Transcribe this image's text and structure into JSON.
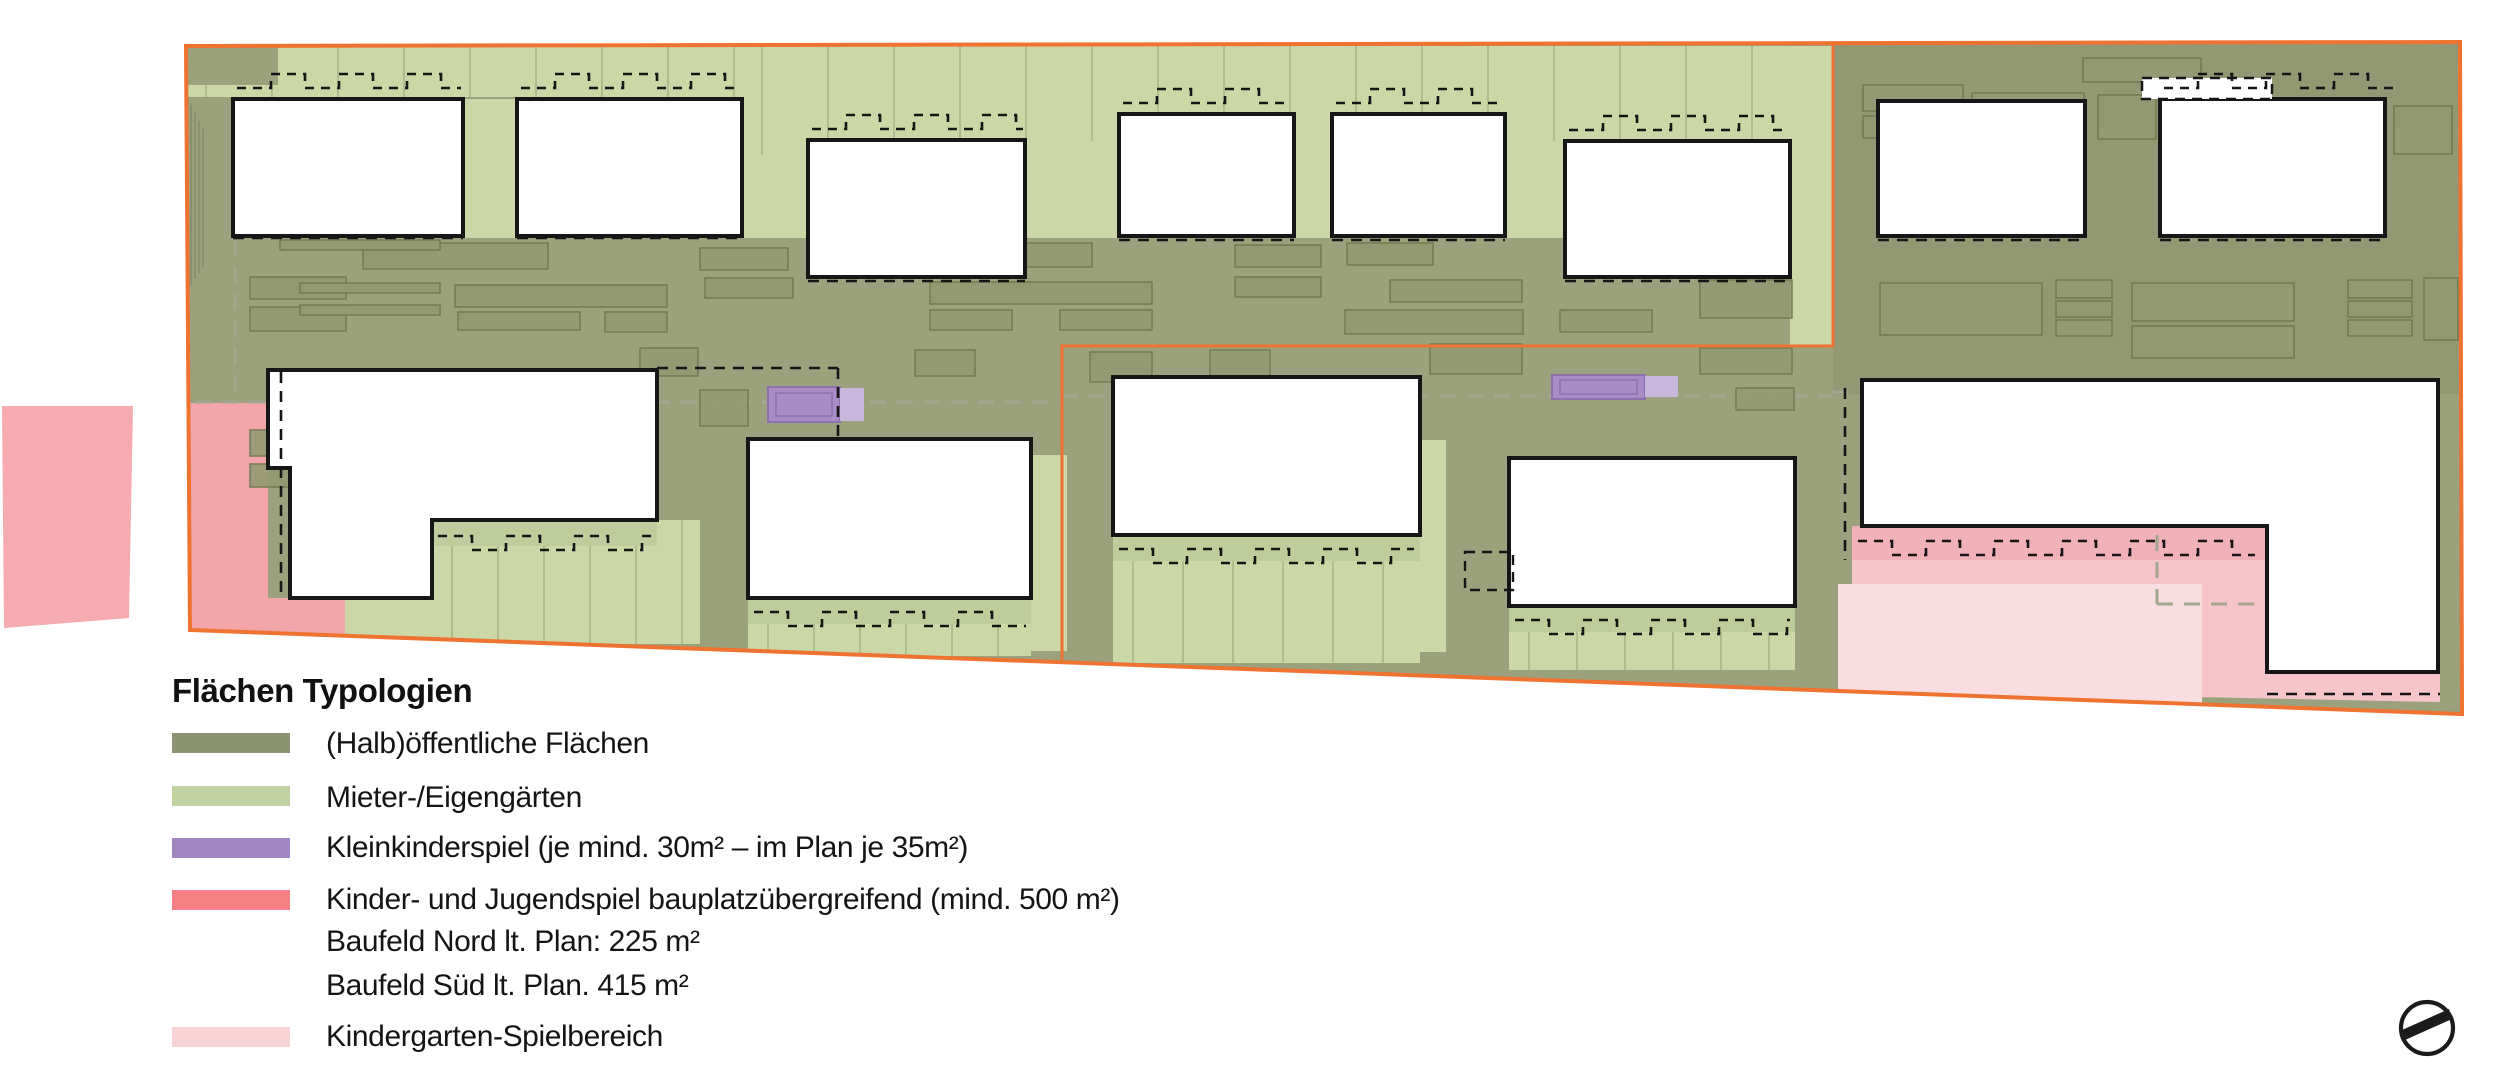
{
  "legend": {
    "title": "Flächen Typologien",
    "items": [
      {
        "id": "halboeffentliche",
        "label": "(Halb)öffentliche Flächen",
        "color": "#8c9472"
      },
      {
        "id": "mieter-eigengaerten",
        "label": "Mieter-/Eigengärten",
        "color": "#c2d2a0"
      },
      {
        "id": "kleinkinderspiel",
        "label": "Kleinkinderspiel (je mind. 30m² – im Plan je 35m²)",
        "color": "#a186c2"
      },
      {
        "id": "kinder-jugendspiel",
        "label": "Kinder- und Jugendspiel bauplatzübergreifend (mind. 500 m²)",
        "color": "#f47f85",
        "sublines": [
          "Baufeld Nord lt. Plan: 225 m²",
          "Baufeld Süd lt. Plan.   415 m²"
        ]
      },
      {
        "id": "kindergarten-spielbereich",
        "label": "Kindergarten-Spielbereich",
        "color": "#f8d3d6"
      }
    ]
  },
  "plan": {
    "colors": {
      "olive": "#9ba17c",
      "shade": "rgba(70,76,52,0.10)",
      "light": "#cbd7a7",
      "hatch": "#bfcc9c",
      "pink": "#f2a6aa",
      "pinkDetached": "#f5abaf",
      "pinkLight": "#f5c5ca",
      "pinkStrip": "#f0b1b8",
      "pinkLighter": "#fadde0",
      "purple": "#a98bc6",
      "purpleLight": "#c9b6dc",
      "purpleStroke": "#8d6fae",
      "smallFill": "#939a73",
      "smallStroke": "#71784f",
      "white": "#ffffff",
      "black": "#161616",
      "orange": "#ee7330",
      "gray": "#a2a78e",
      "tex": "rgba(110,122,80,0.40)"
    },
    "boundary": [
      [
        186,
        46
      ],
      [
        2460,
        42
      ],
      [
        2462,
        714
      ],
      [
        190,
        630
      ]
    ],
    "divider": [
      [
        1833,
        42
      ],
      [
        1833,
        346
      ],
      [
        1062,
        346
      ],
      [
        1062,
        660
      ]
    ],
    "zones": [
      {
        "t": "poly",
        "f": "olive",
        "pts": [
          [
            186,
            46
          ],
          [
            2460,
            42
          ],
          [
            2462,
            714
          ],
          [
            190,
            630
          ]
        ]
      },
      {
        "t": "rect",
        "f": "shade",
        "x": 1833,
        "y": 42,
        "w": 627,
        "h": 352
      },
      {
        "t": "rect",
        "f": "light",
        "x": 186,
        "y": 46,
        "w": 1647,
        "h": 51,
        "ln": 66
      },
      {
        "t": "rect",
        "f": "light",
        "x": 742,
        "y": 46,
        "w": 1091,
        "h": 109,
        "ln": 66
      },
      {
        "t": "rect",
        "f": "olive",
        "x": 186,
        "y": 46,
        "w": 92,
        "h": 39
      },
      {
        "t": "rect",
        "f": "light",
        "x": 463,
        "y": 99,
        "w": 54,
        "h": 139
      },
      {
        "t": "rect",
        "f": "light",
        "x": 742,
        "y": 155,
        "w": 66,
        "h": 83
      },
      {
        "t": "rect",
        "f": "light",
        "x": 1025,
        "y": 141,
        "w": 94,
        "h": 97
      },
      {
        "t": "rect",
        "f": "light",
        "x": 1294,
        "y": 114,
        "w": 38,
        "h": 124
      },
      {
        "t": "rect",
        "f": "light",
        "x": 1505,
        "y": 141,
        "w": 60,
        "h": 97
      },
      {
        "t": "rect",
        "f": "light",
        "x": 1790,
        "y": 46,
        "w": 43,
        "h": 300
      },
      {
        "t": "rect",
        "f": "light",
        "x": 432,
        "y": 520,
        "w": 268,
        "h": 124,
        "ln": 46
      },
      {
        "t": "rect",
        "f": "hatch",
        "x": 432,
        "y": 520,
        "w": 225,
        "h": 26
      },
      {
        "t": "rect",
        "f": "light",
        "x": 345,
        "y": 598,
        "w": 87,
        "h": 46
      },
      {
        "t": "rect",
        "f": "light",
        "x": 748,
        "y": 598,
        "w": 283,
        "h": 58,
        "ln": 46
      },
      {
        "t": "rect",
        "f": "hatch",
        "x": 748,
        "y": 598,
        "w": 283,
        "h": 26
      },
      {
        "t": "rect",
        "f": "light",
        "x": 1031,
        "y": 455,
        "w": 36,
        "h": 196
      },
      {
        "t": "rect",
        "f": "light",
        "x": 1113,
        "y": 535,
        "w": 307,
        "h": 128,
        "ln": 50
      },
      {
        "t": "rect",
        "f": "hatch",
        "x": 1113,
        "y": 535,
        "w": 307,
        "h": 26
      },
      {
        "t": "rect",
        "f": "light",
        "x": 1420,
        "y": 440,
        "w": 26,
        "h": 212
      },
      {
        "t": "rect",
        "f": "light",
        "x": 1509,
        "y": 606,
        "w": 286,
        "h": 64,
        "ln": 48
      },
      {
        "t": "rect",
        "f": "hatch",
        "x": 1509,
        "y": 606,
        "w": 286,
        "h": 26
      },
      {
        "t": "poly",
        "f": "pink",
        "pts": [
          [
            190,
            403
          ],
          [
            268,
            403
          ],
          [
            268,
            598
          ],
          [
            345,
            598
          ],
          [
            345,
            636
          ],
          [
            190,
            628
          ]
        ]
      },
      {
        "t": "poly",
        "f": "pinkLight",
        "pts": [
          [
            1852,
            526
          ],
          [
            2267,
            526
          ],
          [
            2267,
            672
          ],
          [
            2440,
            672
          ],
          [
            2440,
            702
          ],
          [
            1852,
            690
          ]
        ]
      },
      {
        "t": "rect",
        "f": "pinkStrip",
        "x": 1852,
        "y": 526,
        "w": 415,
        "h": 34
      },
      {
        "t": "rect",
        "f": "pinkLighter",
        "x": 1838,
        "y": 584,
        "w": 364,
        "h": 122
      }
    ],
    "small_rects": [
      [
        363,
        243,
        185,
        26
      ],
      [
        455,
        285,
        212,
        22
      ],
      [
        458,
        312,
        122,
        18
      ],
      [
        250,
        277,
        96,
        22
      ],
      [
        250,
        307,
        96,
        24
      ],
      [
        605,
        312,
        62,
        20
      ],
      [
        700,
        248,
        88,
        22
      ],
      [
        705,
        278,
        88,
        20
      ],
      [
        900,
        243,
        192,
        24
      ],
      [
        930,
        282,
        222,
        22
      ],
      [
        930,
        310,
        82,
        20
      ],
      [
        1060,
        310,
        92,
        20
      ],
      [
        1235,
        245,
        86,
        22
      ],
      [
        1235,
        277,
        86,
        20
      ],
      [
        1347,
        243,
        86,
        22
      ],
      [
        1390,
        280,
        132,
        22
      ],
      [
        1345,
        310,
        178,
        24
      ],
      [
        1560,
        310,
        92,
        22
      ],
      [
        1620,
        248,
        96,
        22
      ],
      [
        1700,
        280,
        92,
        38
      ],
      [
        280,
        240,
        160,
        10
      ],
      [
        300,
        283,
        140,
        10
      ],
      [
        300,
        305,
        140,
        10
      ],
      [
        640,
        348,
        58,
        28
      ],
      [
        915,
        350,
        60,
        26
      ],
      [
        1090,
        352,
        62,
        30
      ],
      [
        1142,
        390,
        58,
        24
      ],
      [
        1210,
        350,
        60,
        26
      ],
      [
        1430,
        344,
        92,
        30
      ],
      [
        1700,
        348,
        92,
        26
      ],
      [
        1736,
        388,
        58,
        22
      ],
      [
        700,
        390,
        48,
        36
      ],
      [
        1863,
        85,
        100,
        26
      ],
      [
        1863,
        116,
        100,
        22
      ],
      [
        1972,
        93,
        112,
        26
      ],
      [
        2098,
        95,
        58,
        44
      ],
      [
        2312,
        106,
        72,
        56
      ],
      [
        2394,
        106,
        58,
        48
      ],
      [
        2083,
        58,
        118,
        24
      ],
      [
        1880,
        283,
        162,
        52
      ],
      [
        2056,
        280,
        56,
        18
      ],
      [
        2056,
        301,
        56,
        16
      ],
      [
        2056,
        320,
        56,
        16
      ],
      [
        2132,
        283,
        162,
        38
      ],
      [
        2132,
        326,
        162,
        32
      ],
      [
        2348,
        280,
        64,
        18
      ],
      [
        2348,
        301,
        64,
        16
      ],
      [
        2348,
        320,
        64,
        16
      ],
      [
        2424,
        278,
        34,
        62
      ],
      [
        1863,
        390,
        122,
        28
      ],
      [
        2010,
        386,
        152,
        32
      ],
      [
        2195,
        390,
        102,
        28
      ],
      [
        250,
        430,
        62,
        26
      ],
      [
        250,
        464,
        62,
        23
      ]
    ],
    "purple_areas": [
      {
        "x": 768,
        "y": 387,
        "w": 72,
        "h": 35,
        "ix": 776,
        "iy": 393,
        "iw": 56,
        "ih": 23,
        "ex": 840,
        "ey": 388,
        "ew": 24,
        "eh": 33
      },
      {
        "x": 1552,
        "y": 375,
        "w": 93,
        "h": 24,
        "ix": 1560,
        "iy": 380,
        "iw": 77,
        "ih": 14,
        "ex": 1645,
        "ey": 376,
        "ew": 33,
        "eh": 21
      }
    ],
    "buildings": [
      {
        "t": "rect",
        "x": 233,
        "y": 99,
        "w": 230,
        "h": 137
      },
      {
        "t": "rect",
        "x": 517,
        "y": 99,
        "w": 225,
        "h": 137
      },
      {
        "t": "rect",
        "x": 808,
        "y": 140,
        "w": 217,
        "h": 137
      },
      {
        "t": "rect",
        "x": 1119,
        "y": 114,
        "w": 175,
        "h": 122
      },
      {
        "t": "rect",
        "x": 1332,
        "y": 114,
        "w": 173,
        "h": 122
      },
      {
        "t": "rect",
        "x": 1565,
        "y": 141,
        "w": 225,
        "h": 136
      },
      {
        "t": "rect",
        "x": 1878,
        "y": 101,
        "w": 207,
        "h": 135
      },
      {
        "t": "rect",
        "x": 2160,
        "y": 99,
        "w": 225,
        "h": 137
      },
      {
        "t": "poly",
        "pts": [
          [
            268,
            370
          ],
          [
            657,
            370
          ],
          [
            657,
            520
          ],
          [
            432,
            520
          ],
          [
            432,
            598
          ],
          [
            290,
            598
          ],
          [
            290,
            468
          ],
          [
            268,
            468
          ]
        ]
      },
      {
        "t": "rect",
        "x": 748,
        "y": 439,
        "w": 283,
        "h": 159
      },
      {
        "t": "rect",
        "x": 1113,
        "y": 377,
        "w": 307,
        "h": 158
      },
      {
        "t": "rect",
        "x": 1509,
        "y": 458,
        "w": 286,
        "h": 148
      },
      {
        "t": "poly",
        "pts": [
          [
            1862,
            380
          ],
          [
            2438,
            380
          ],
          [
            2438,
            672
          ],
          [
            2267,
            672
          ],
          [
            2267,
            526
          ],
          [
            1862,
            526
          ]
        ]
      }
    ],
    "building_strip": {
      "x": 2142,
      "y": 78,
      "w": 130,
      "h": 21
    },
    "dashes_black": [
      [
        233,
        238,
        463,
        238
      ],
      [
        517,
        238,
        742,
        238
      ],
      [
        808,
        281,
        1025,
        281
      ],
      [
        1565,
        281,
        1790,
        281
      ],
      [
        1119,
        240,
        1294,
        240
      ],
      [
        1332,
        240,
        1505,
        240
      ],
      [
        1878,
        240,
        2085,
        240
      ],
      [
        2160,
        240,
        2385,
        240
      ],
      [
        281,
        372,
        281,
        594
      ],
      [
        657,
        368,
        838,
        368
      ],
      [
        838,
        368,
        838,
        442
      ],
      [
        1845,
        388,
        1845,
        560
      ],
      [
        2267,
        694,
        2440,
        694
      ]
    ],
    "dashed_boxes": [
      [
        1465,
        552,
        48,
        38
      ]
    ],
    "castellations": [
      [
        237,
        461,
        88,
        14
      ],
      [
        521,
        738,
        88,
        14
      ],
      [
        812,
        1023,
        129,
        14
      ],
      [
        1123,
        1290,
        103,
        14
      ],
      [
        1336,
        1501,
        103,
        14
      ],
      [
        1569,
        1786,
        130,
        14
      ],
      [
        2164,
        2400,
        88,
        14
      ],
      [
        438,
        652,
        536,
        -14
      ],
      [
        754,
        1026,
        612,
        -14
      ],
      [
        1119,
        1414,
        549,
        -14
      ],
      [
        1515,
        1790,
        620,
        -14
      ],
      [
        1858,
        2255,
        541,
        -14
      ]
    ],
    "dashes_gray": [
      [
        195,
        402,
        1060,
        402
      ],
      [
        1062,
        396,
        1831,
        396
      ],
      [
        1833,
        392,
        2430,
        392
      ],
      [
        235,
        240,
        235,
        400
      ],
      [
        2157,
        535,
        2157,
        604
      ],
      [
        2157,
        604,
        2267,
        604
      ]
    ],
    "stairs": {
      "x0": 191,
      "step": 4,
      "count": 4,
      "y1": 105,
      "y2": 285
    },
    "pink_detached": [
      [
        2,
        406
      ],
      [
        133,
        406
      ],
      [
        129,
        618
      ],
      [
        4,
        628
      ]
    ],
    "compass": {
      "cx": 2427,
      "cy": 1028,
      "r": 26,
      "needle": [
        [
          2405,
          1040
        ],
        [
          2452,
          1019
        ],
        [
          2449,
          1009
        ],
        [
          2402,
          1030
        ]
      ]
    }
  }
}
